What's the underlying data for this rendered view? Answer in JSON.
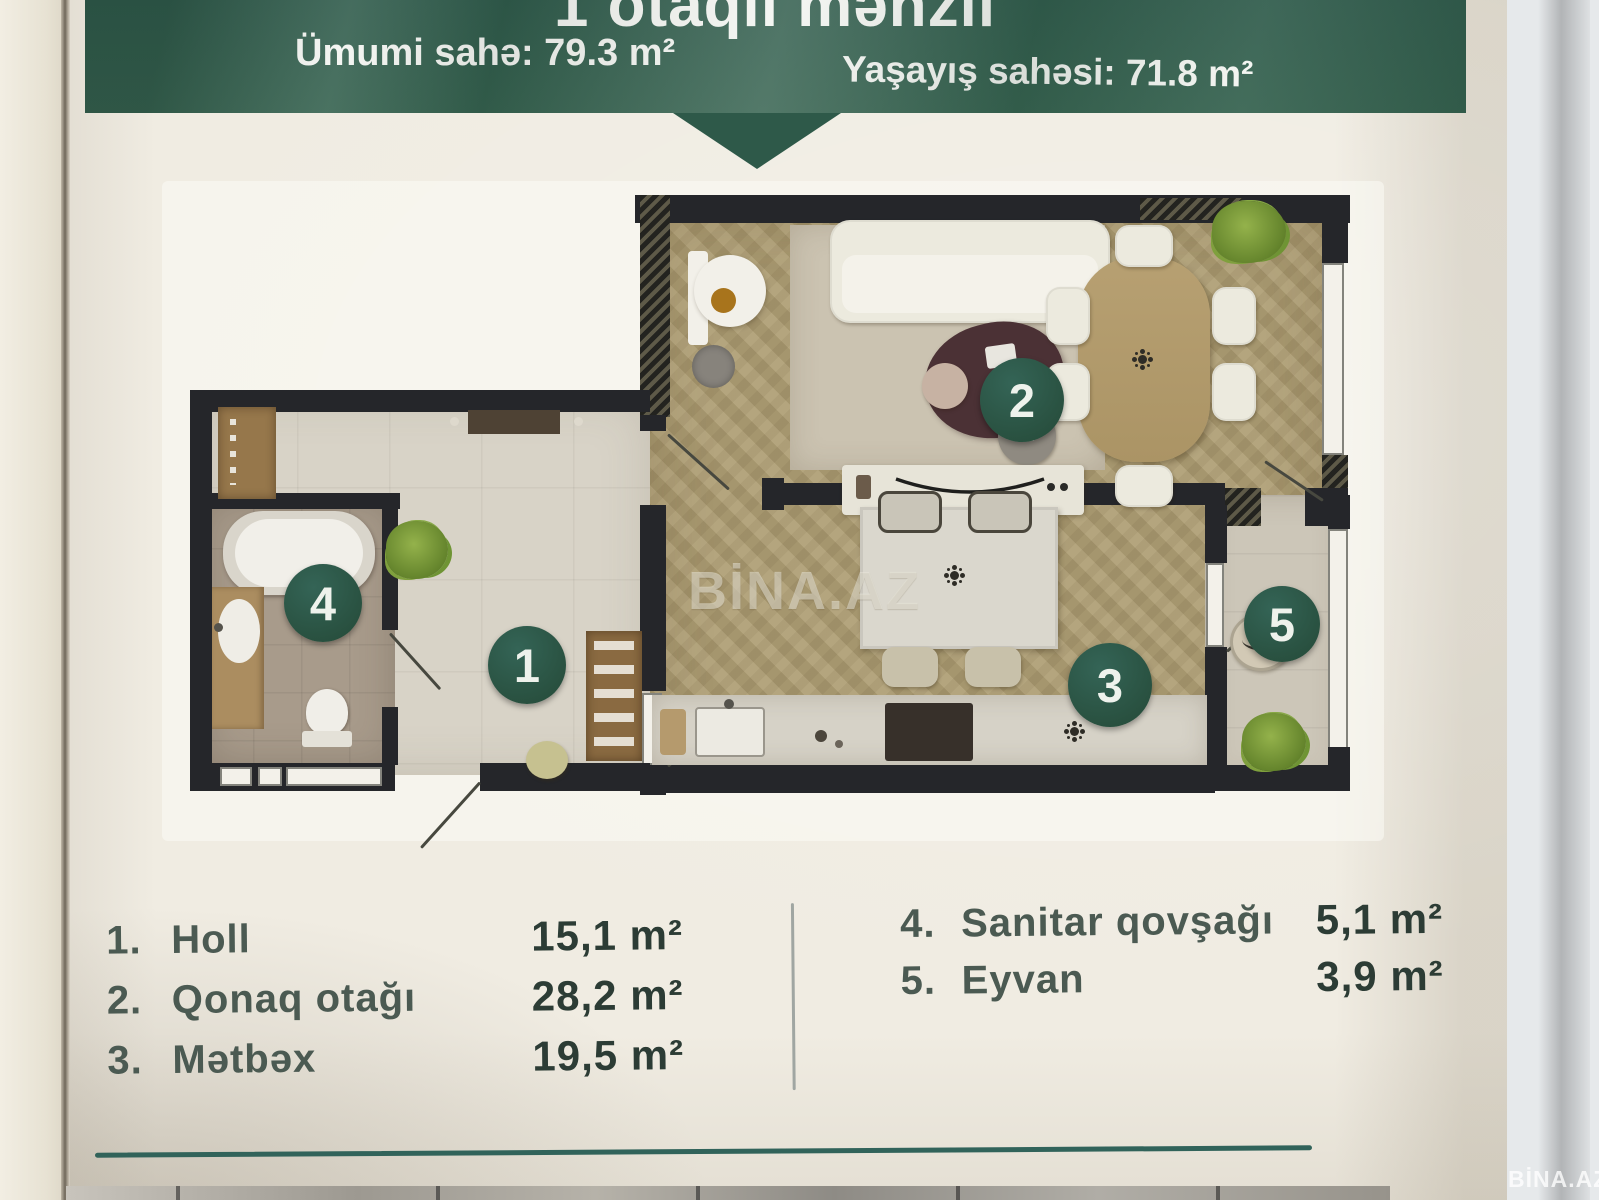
{
  "banner": {
    "title": "1 otaqlı mənzil",
    "total_area": "Ümumi sahə: 79.3 m²",
    "living_area": "Yaşayış sahəsi: 71.8 m²",
    "color": "#33604f"
  },
  "plan": {
    "markers": [
      "1",
      "2",
      "3",
      "4",
      "5"
    ],
    "watermark": "BİNA.AZ",
    "marker_color": "#2c584a",
    "wall_color": "#25262a"
  },
  "legend": {
    "left": [
      {
        "num": "1.",
        "name": "Holl",
        "area": "15,1 m²"
      },
      {
        "num": "2.",
        "name": "Qonaq otağı",
        "area": "28,2 m²"
      },
      {
        "num": "3.",
        "name": "Mətbəx",
        "area": "19,5 m²"
      }
    ],
    "right": [
      {
        "num": "4.",
        "name": "Sanitar qovşağı",
        "area": "5,1 m²"
      },
      {
        "num": "5.",
        "name": "Eyvan",
        "area": "3,9 m²"
      }
    ]
  },
  "footer": {
    "corner_watermark": "BİNA.AZ",
    "line_color": "#31635a"
  }
}
